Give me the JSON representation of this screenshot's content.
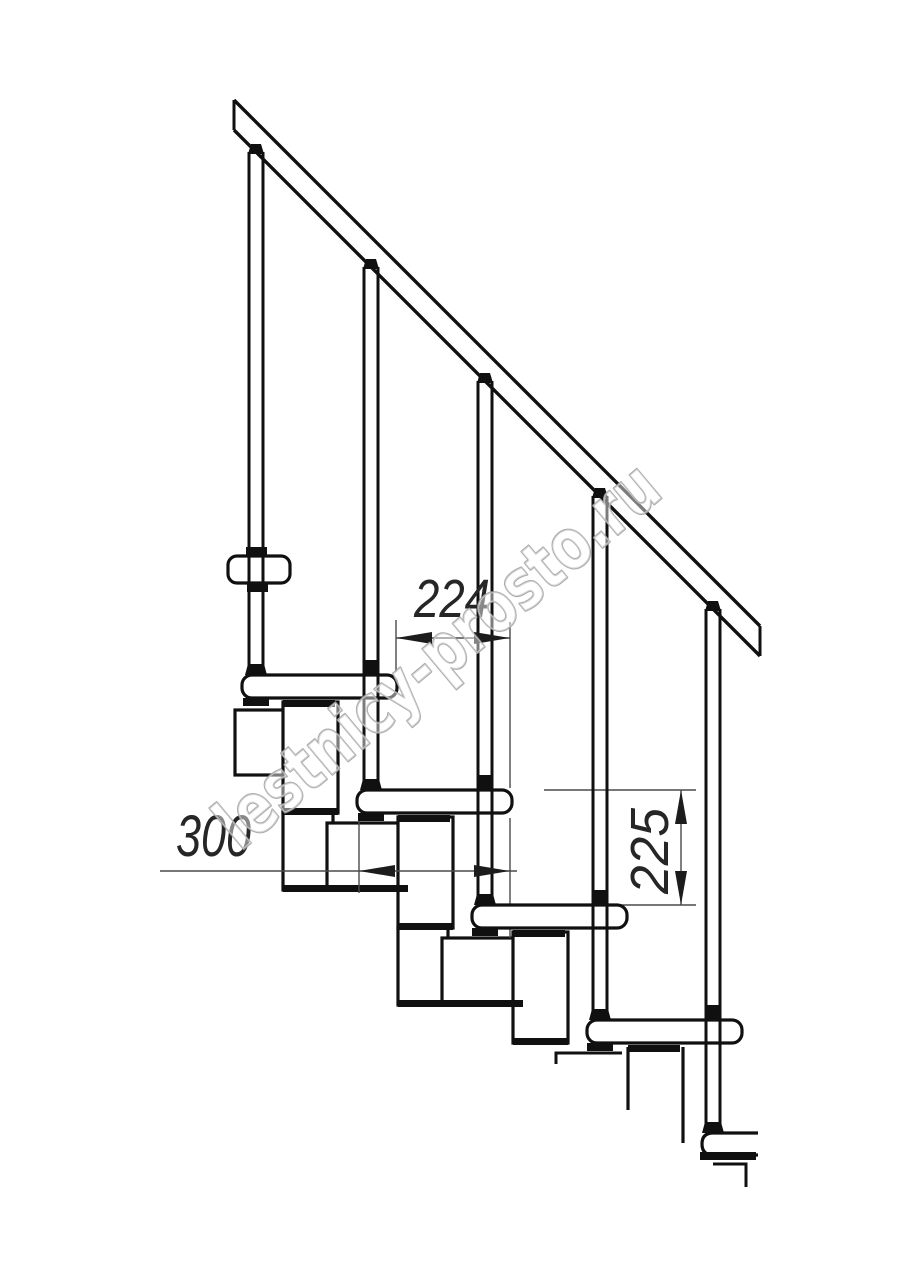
{
  "drawing": {
    "type": "staircase-side-elevation-modular",
    "title": "Modular staircase side elevation drawing",
    "watermark": {
      "text": "lestnicy-prosto.ru"
    },
    "dimensions": [
      {
        "id": "going",
        "label": "224",
        "orientation": "horizontal"
      },
      {
        "id": "tread-depth",
        "label": "300",
        "orientation": "horizontal"
      },
      {
        "id": "rise",
        "label": "225",
        "orientation": "vertical"
      }
    ],
    "counts": {
      "treads": 5,
      "balusters": 5,
      "support_modules": 4,
      "handrails": 1
    },
    "colors": {
      "ink": "#101010",
      "dim_line": "#4a4a4a",
      "dim_text": "#262626",
      "watermark_outline": "#a3a3a3",
      "background": "#ffffff"
    }
  }
}
